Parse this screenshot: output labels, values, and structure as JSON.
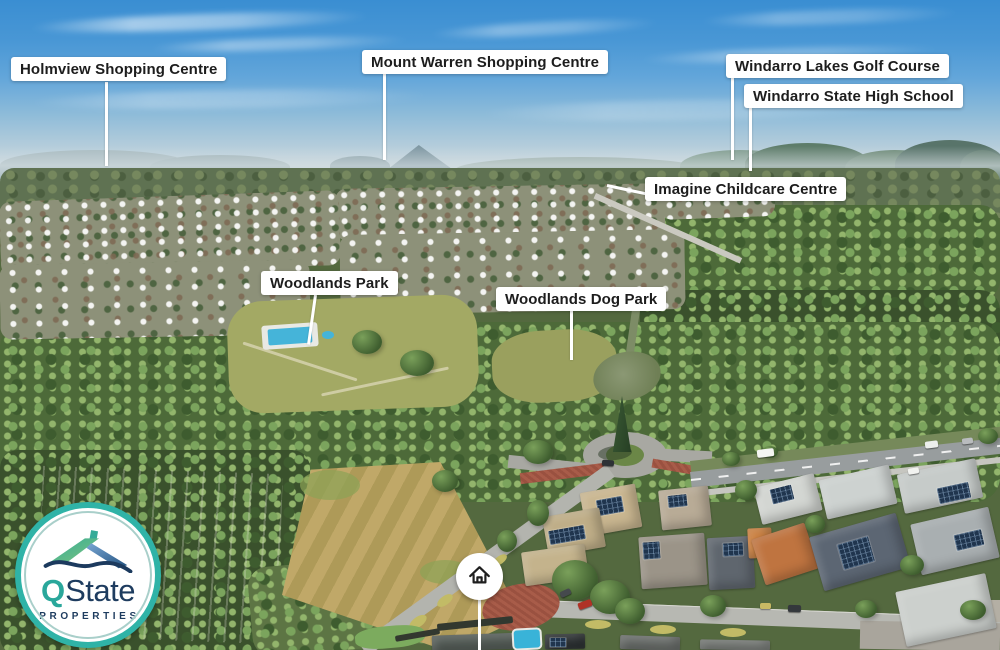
{
  "page": {
    "type": "aerial-suburb-location-map",
    "width_px": 1000,
    "height_px": 650
  },
  "location_labels": [
    {
      "id": "holmview-shopping-centre",
      "text": "Holmview Shopping Centre"
    },
    {
      "id": "mount-warren-shopping-centre",
      "text": "Mount Warren Shopping Centre"
    },
    {
      "id": "windarro-lakes-golf-course",
      "text": "Windarro Lakes Golf Course"
    },
    {
      "id": "windarro-state-high-school",
      "text": "Windarro State High School"
    },
    {
      "id": "imagine-childcare-centre",
      "text": "Imagine Childcare Centre"
    },
    {
      "id": "woodlands-park",
      "text": "Woodlands Park"
    },
    {
      "id": "woodlands-dog-park",
      "text": "Woodlands Dog Park"
    }
  ],
  "property_marker": {
    "icon": "house-icon",
    "circle_color": "#ffffff",
    "icon_color": "#1f1f1f"
  },
  "logo": {
    "brand_q": "Q",
    "brand_state": "State",
    "tagline": "PROPERTIES",
    "ring_color": "#2fb3a7",
    "teal": "#2aa79b",
    "navy": "#1e3c5f"
  },
  "style": {
    "label_bg": "#ffffff",
    "label_text": "#1d1d1d",
    "pointer_color": "#ffffff"
  }
}
